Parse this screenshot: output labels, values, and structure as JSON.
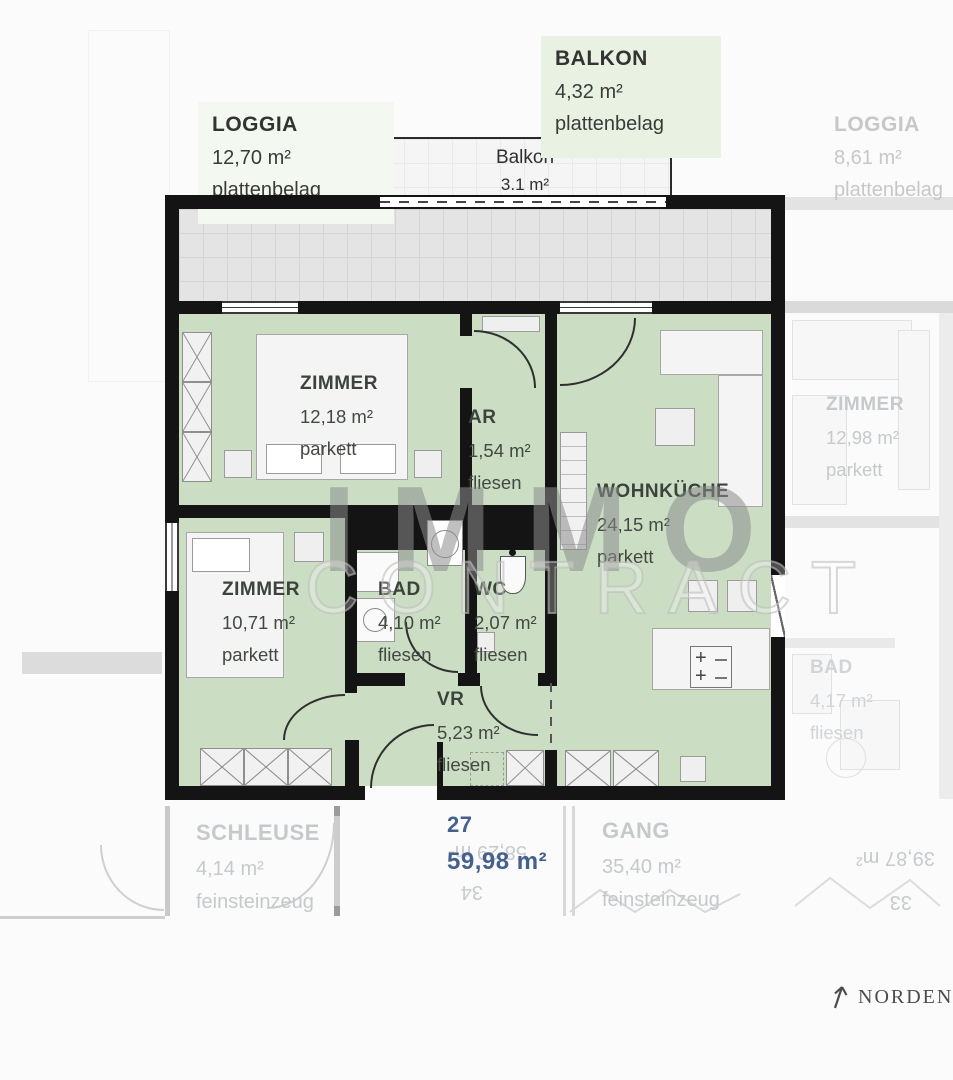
{
  "colors": {
    "room_fill": "#cbdec4",
    "terrace_fill": "#e4e4e4",
    "wall": "#141414",
    "accent_blue": "#44608e",
    "faded_text": "#c6c9cb",
    "balkon_label_bg": "#e9f2e2"
  },
  "watermark": {
    "line1": "IMMO",
    "line2": "CONTRACT"
  },
  "exterior": {
    "loggia_left": {
      "title": "LOGGIA",
      "area": "12,70 m²",
      "finish": "plattenbelag"
    },
    "balkon": {
      "title": "BALKON",
      "area": "4,32 m²",
      "finish": "plattenbelag"
    },
    "loggia_right": {
      "title": "LOGGIA",
      "area": "8,61 m²",
      "finish": "plattenbelag"
    },
    "balkon_inline": {
      "title": "Balkon",
      "area": "3.1 m²"
    }
  },
  "rooms": {
    "zimmer1": {
      "name": "ZIMMER",
      "area": "12,18 m²",
      "finish": "parkett"
    },
    "ar": {
      "name": "AR",
      "area": "1,54 m²",
      "finish": "fliesen"
    },
    "wohnkueche": {
      "name": "WOHNKÜCHE",
      "area": "24,15 m²",
      "finish": "parkett"
    },
    "zimmer2": {
      "name": "ZIMMER",
      "area": "10,71 m²",
      "finish": "parkett"
    },
    "bad": {
      "name": "BAD",
      "area": "4,10 m²",
      "finish": "fliesen"
    },
    "wc": {
      "name": "WC",
      "area": "2,07 m²",
      "finish": "fliesen"
    },
    "vr": {
      "name": "VR",
      "area": "5,23 m²",
      "finish": "fliesen"
    }
  },
  "unit": {
    "number": "27",
    "total_area": "59,98 m²"
  },
  "neighbors": {
    "zimmer_right": {
      "name": "ZIMMER",
      "area": "12,98 m²",
      "finish": "parkett"
    },
    "bad_right": {
      "name": "BAD",
      "area": "4,17 m²",
      "finish": "fliesen"
    },
    "schleuse": {
      "name": "SCHLEUSE",
      "area": "4,14 m²",
      "finish": "feinsteinzeug"
    },
    "gang": {
      "name": "GANG",
      "area": "35,40 m²",
      "finish": "feinsteinzeug"
    },
    "unit_34": {
      "area": "58,29 m²",
      "number": "34"
    },
    "unit_33": {
      "area": "39,87 m²",
      "number": "33"
    }
  },
  "compass": {
    "label": "NORDEN"
  }
}
